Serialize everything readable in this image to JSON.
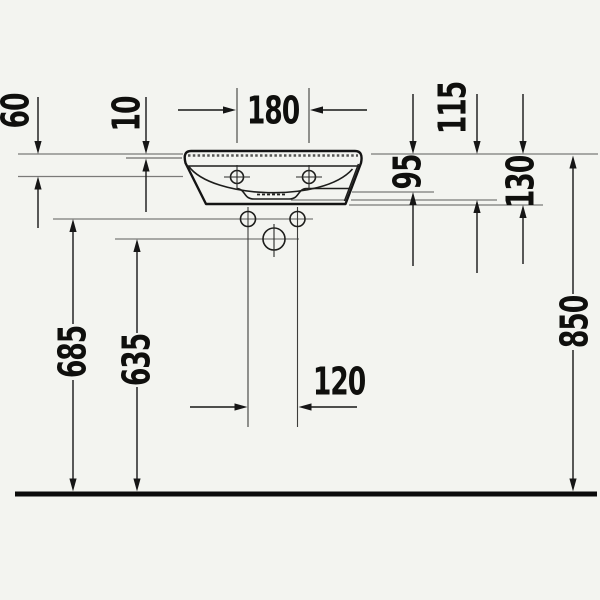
{
  "diagram": {
    "kind": "technical-dimension-drawing",
    "view": "washbasin-front-elevation",
    "dimensions": {
      "rim_offset_60": "60",
      "rim_edge_10": "10",
      "tap_centres_180": "180",
      "depth_95": "95",
      "depth_115": "115",
      "depth_130": "130",
      "fixing_height_685": "685",
      "outlet_height_635": "635",
      "fixing_centres_120": "120",
      "rim_height_850": "850"
    },
    "colors": {
      "ink": "#161616",
      "paper": "#f3f4f0",
      "reference_line": "#7a7a78",
      "floor": "#0b0b0b"
    }
  }
}
